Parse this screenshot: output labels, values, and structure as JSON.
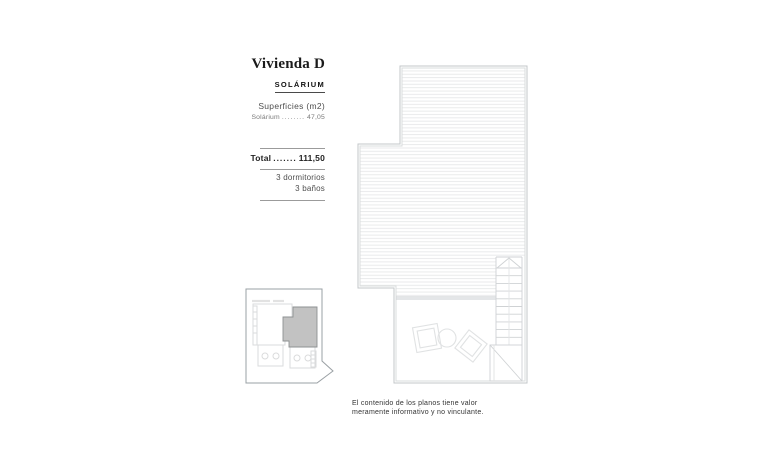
{
  "colors": {
    "highlight_fill": "#c2c2c2",
    "plan_line": "#c3c7ca",
    "hatch_line": "#e7e8e9",
    "text_dark": "#1b1b1b"
  },
  "panel": {
    "title": "Vivienda D",
    "subtitle": "SOLÁRIUM",
    "surfaces_heading": "Superficies (m2)",
    "surface_rows": [
      {
        "label": "Solárium",
        "dots": "........",
        "value": "47,05"
      }
    ],
    "total_label": "Total",
    "total_dots": ".......",
    "total_value": "111,50",
    "details": [
      "3 dormitorios",
      "3 baños"
    ]
  },
  "disclaimer": {
    "line1": "El contenido de los planos tiene valor",
    "line2": "meramente informativo y no vinculante."
  }
}
